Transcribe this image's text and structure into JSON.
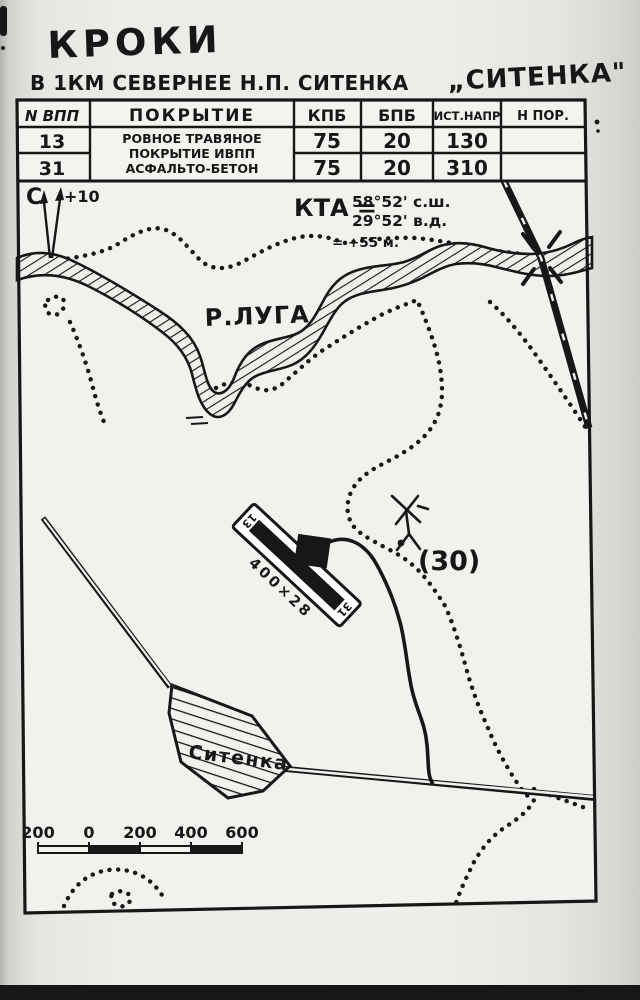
{
  "document": {
    "title": "КРОКИ",
    "subtitle": "В 1КМ СЕВЕРНЕЕ Н.П. СИТЕНКА",
    "airfield_name_quoted": "„СИТЕНКА\""
  },
  "runway_table": {
    "headers": [
      "N ВПП",
      "ПОКРЫТИЕ",
      "КПБ",
      "БПБ",
      "ИСТ.НАПР",
      "Н ПОР."
    ],
    "rows": [
      {
        "runway": "13",
        "kpb": "75",
        "bpb": "20",
        "true_heading": "130"
      },
      {
        "runway": "31",
        "kpb": "75",
        "bpb": "20",
        "true_heading": "310"
      }
    ],
    "surface_lines": [
      "РОВНОЕ ТРАВЯНОЕ",
      "ПОКРЫТИЕ ИВПП",
      "АСФАЛЬТО-БЕТОН"
    ]
  },
  "kta": {
    "label": "КТА =",
    "latitude": "58°52' с.ш.",
    "longitude": "29°52' в.д.",
    "elevation": "= +55 м."
  },
  "north_indicator": {
    "north_label": "С",
    "declination": "+10"
  },
  "map_labels": {
    "river": "Р.ЛУГА",
    "settlement": "Ситенка",
    "spot_elevation": "(30)",
    "runway_dimensions": "400×28",
    "runway_end_north": "13",
    "runway_end_south": "31"
  },
  "scale_bar": {
    "labels": [
      "200",
      "0",
      "200",
      "400",
      "600"
    ]
  },
  "colors": {
    "ink": "#171717",
    "paper": "#f2f1ed"
  }
}
